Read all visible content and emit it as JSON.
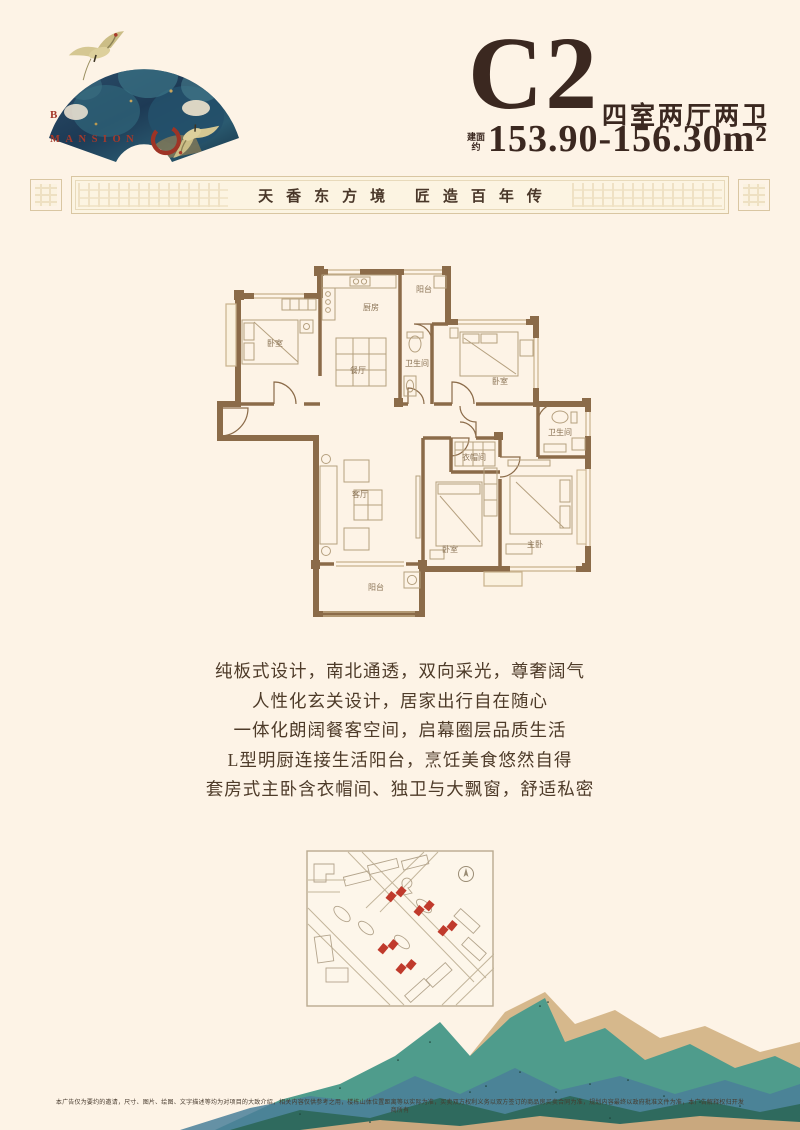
{
  "logo": {
    "brand_line1": "B",
    "brand_line2": "MANSION"
  },
  "header": {
    "unit_code": "C2",
    "unit_type": "四室两厅两卫",
    "area_label": "建面约",
    "area_value": "153.90-156.30m²"
  },
  "banner": {
    "slogan": "天香东方境 匠造百年传"
  },
  "floorplan": {
    "rooms": [
      {
        "label": "卧室"
      },
      {
        "label": "厨房"
      },
      {
        "label": "阳台"
      },
      {
        "label": "餐厅"
      },
      {
        "label": "卫生间"
      },
      {
        "label": "卧室"
      },
      {
        "label": "卫生间"
      },
      {
        "label": "衣帽间"
      },
      {
        "label": "客厅"
      },
      {
        "label": "卧室"
      },
      {
        "label": "主卧"
      },
      {
        "label": "阳台"
      }
    ]
  },
  "features": [
    "纯板式设计，南北通透，双向采光，尊奢阔气",
    "人性化玄关设计，居家出行自在随心",
    "一体化朗阔餐客空间，启幕圈层品质生活",
    "L型明厨连接生活阳台，烹饪美食悠然自得",
    "套房式主卧含衣帽间、独卫与大飘窗，舒适私密"
  ],
  "disclaimer": "本广告仅为要约的邀请，尺寸、图片、绘图、文字描述等均为对项目的大致介绍，相关内容仅供参考之用，楼栋山体位置距离等以实际为准，买卖双方权利义务以双方签订的商品房买卖合同为准，规划内容最终以政府批准文件为准，本广告解释权归开发商所有",
  "colors": {
    "background": "#fdf3e6",
    "title_brown": "#3b2820",
    "wall_brown": "#8b6b49",
    "accent_red": "#a73a2a",
    "map_red": "#c03a2c",
    "mountain_teal": "#4f9c8c",
    "mountain_tan": "#d6b88c"
  }
}
